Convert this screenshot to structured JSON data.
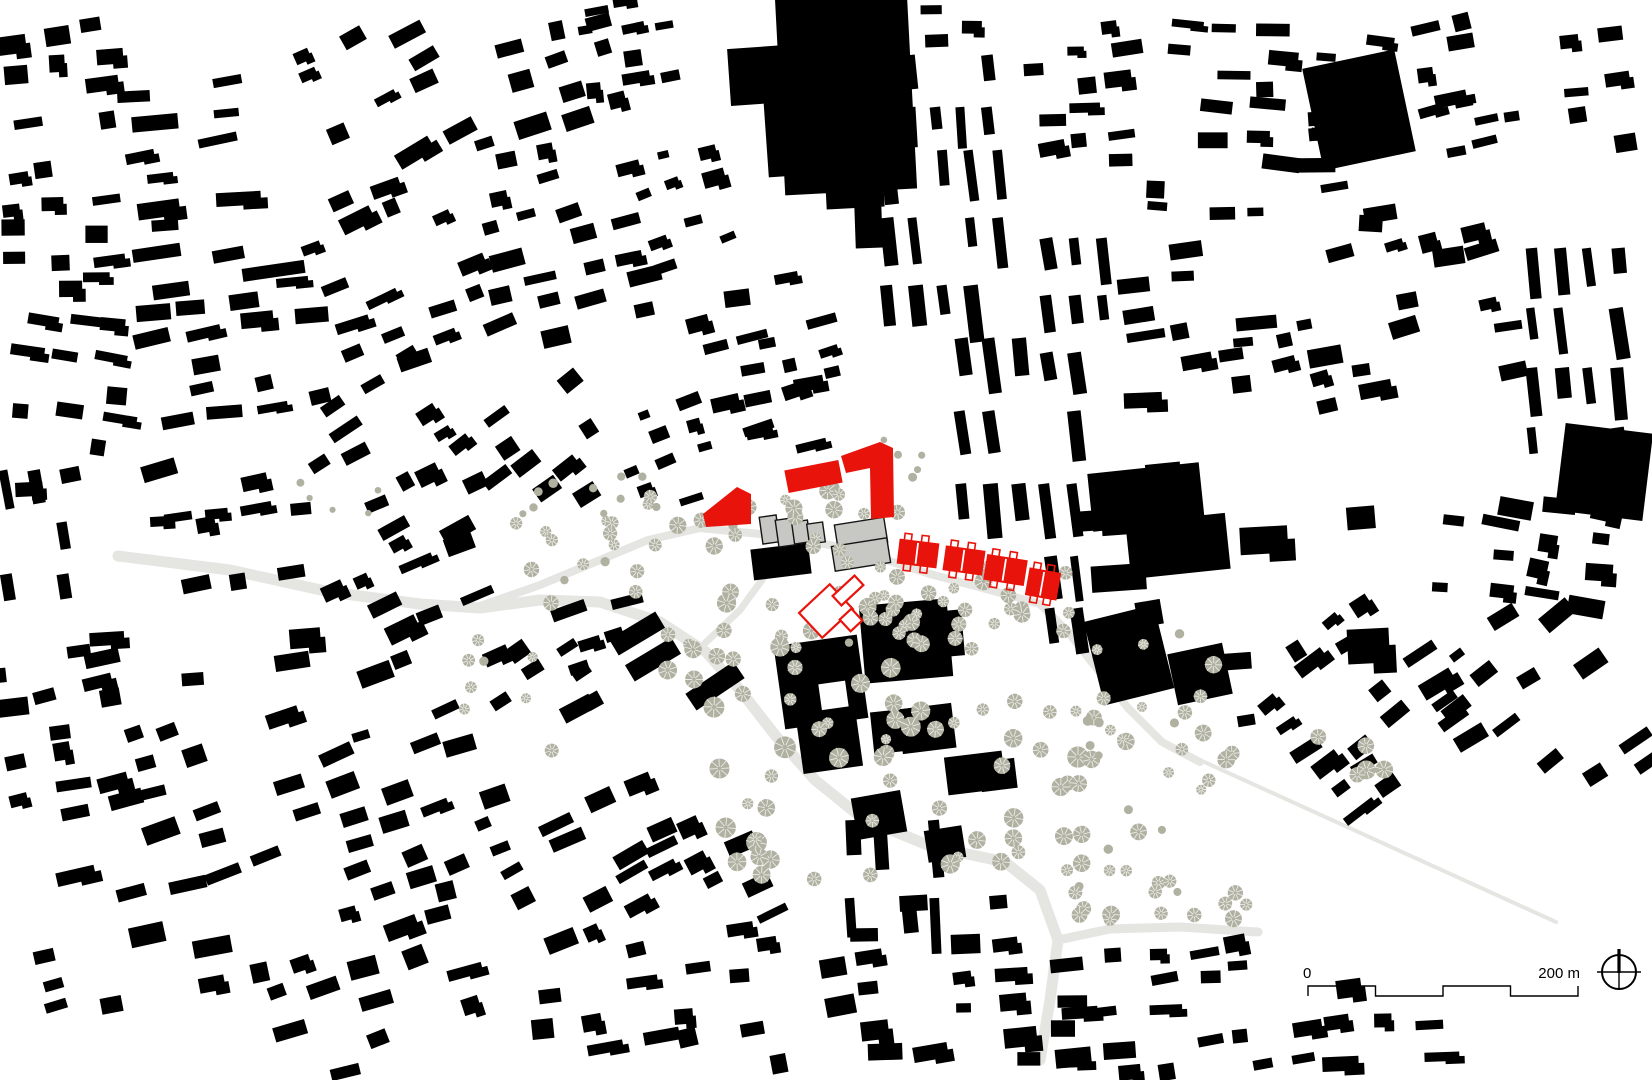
{
  "map": {
    "kind": "architectural figure-ground site plan",
    "canvas": {
      "w": 1652,
      "h": 1080
    }
  },
  "colors": {
    "background": "#ffffff",
    "building_black": "#000000",
    "accent_red": "#e8140b",
    "gray_building_fill": "#c7c7c3",
    "gray_building_stroke": "#141414",
    "tree": "#b1b1a2",
    "tree_spoke": "#ffffff",
    "road": "#e5e5e2",
    "ink": "#000000"
  },
  "scale_bar": {
    "label_start": "0",
    "label_end": "200 m",
    "x": 1308,
    "y": 986,
    "length": 270,
    "segments": 4,
    "drop": 10
  },
  "compass": {
    "cx": 1619,
    "cy": 972,
    "r": 17
  },
  "roads": [
    {
      "w": 11,
      "p": [
        [
          118,
          556
        ],
        [
          230,
          570
        ],
        [
          330,
          592
        ],
        [
          420,
          604
        ],
        [
          480,
          608
        ],
        [
          540,
          600
        ],
        [
          600,
          602
        ],
        [
          660,
          622
        ],
        [
          706,
          652
        ],
        [
          740,
          690
        ],
        [
          775,
          735
        ],
        [
          815,
          780
        ],
        [
          862,
          818
        ],
        [
          930,
          846
        ],
        [
          1005,
          862
        ],
        [
          1040,
          890
        ],
        [
          1058,
          940
        ],
        [
          1050,
          1000
        ],
        [
          1040,
          1060
        ]
      ]
    },
    {
      "w": 9,
      "p": [
        [
          1058,
          940
        ],
        [
          1110,
          929
        ],
        [
          1180,
          927
        ],
        [
          1258,
          932
        ]
      ]
    },
    {
      "w": 8,
      "p": [
        [
          480,
          606
        ],
        [
          540,
          585
        ],
        [
          600,
          560
        ],
        [
          648,
          540
        ],
        [
          700,
          528
        ],
        [
          770,
          535
        ],
        [
          830,
          545
        ],
        [
          880,
          558
        ],
        [
          930,
          574
        ],
        [
          990,
          590
        ],
        [
          1040,
          604
        ],
        [
          1068,
          632
        ],
        [
          1098,
          670
        ],
        [
          1128,
          708
        ],
        [
          1162,
          742
        ],
        [
          1200,
          762
        ]
      ]
    },
    {
      "w": 4,
      "p": [
        [
          1200,
          760
        ],
        [
          1556,
          922
        ]
      ]
    },
    {
      "w": 7,
      "p": [
        [
          700,
          648
        ],
        [
          740,
          610
        ],
        [
          762,
          580
        ],
        [
          775,
          552
        ]
      ]
    }
  ],
  "black_clusters": [
    [
      5,
      25,
      150,
      130,
      -8,
      26,
      15,
      0.7,
      11
    ],
    [
      138,
      85,
      158,
      200,
      -7,
      45,
      13,
      0.8,
      22
    ],
    [
      312,
      10,
      165,
      150,
      -27,
      28,
      13,
      0.65,
      33
    ],
    [
      478,
      25,
      175,
      170,
      -15,
      25,
      14,
      0.65,
      44
    ],
    [
      585,
      0,
      95,
      105,
      -8,
      20,
      12,
      0.55,
      55
    ],
    [
      640,
      150,
      90,
      120,
      -18,
      20,
      12,
      0.5,
      66
    ],
    [
      930,
      0,
      80,
      60,
      -4,
      22,
      13,
      0.5,
      77
    ],
    [
      1035,
      25,
      115,
      170,
      -6,
      22,
      13,
      0.6,
      88
    ],
    [
      1160,
      25,
      250,
      200,
      3,
      28,
      13,
      0.65,
      99
    ],
    [
      1420,
      10,
      110,
      160,
      -12,
      24,
      13,
      0.5,
      110
    ],
    [
      1558,
      25,
      90,
      130,
      -8,
      24,
      13,
      0.5,
      115
    ],
    [
      1310,
      95,
      180,
      125,
      -8,
      25,
      13,
      0.45,
      117
    ],
    [
      5,
      165,
      135,
      150,
      -4,
      24,
      14,
      0.6,
      121
    ],
    [
      145,
      290,
      175,
      135,
      -9,
      28,
      14,
      0.7,
      132
    ],
    [
      318,
      175,
      170,
      190,
      -22,
      25,
      14,
      0.6,
      143
    ],
    [
      495,
      205,
      165,
      180,
      -15,
      25,
      14,
      0.6,
      154
    ],
    [
      700,
      285,
      115,
      130,
      -10,
      23,
      13,
      0.55,
      165
    ],
    [
      735,
      330,
      110,
      118,
      -14,
      24,
      13,
      0.6,
      616
    ],
    [
      755,
      418,
      85,
      52,
      -12,
      22,
      12,
      0.55,
      627
    ],
    [
      1120,
      245,
      180,
      170,
      -7,
      30,
      13,
      0.7,
      187
    ],
    [
      1310,
      235,
      205,
      185,
      -13,
      25,
      14,
      0.6,
      198
    ],
    [
      1240,
      330,
      80,
      90,
      -10,
      24,
      13,
      0.5,
      594
    ],
    [
      10,
      320,
      130,
      145,
      7,
      25,
      14,
      0.55,
      220
    ],
    [
      300,
      372,
      180,
      130,
      -30,
      25,
      13,
      0.55,
      231
    ],
    [
      150,
      418,
      165,
      125,
      -12,
      25,
      14,
      0.55,
      242
    ],
    [
      470,
      390,
      160,
      125,
      -34,
      23,
      13,
      0.5,
      253
    ],
    [
      628,
      408,
      85,
      105,
      -20,
      19,
      11,
      0.6,
      264
    ],
    [
      60,
      425,
      80,
      70,
      -10,
      27,
      15,
      0.5,
      286
    ],
    [
      20,
      480,
      70,
      60,
      -6,
      24,
      14,
      0.5,
      660
    ],
    [
      155,
      480,
      170,
      70,
      -8,
      26,
      14,
      0.5,
      649
    ],
    [
      380,
      470,
      110,
      80,
      -25,
      24,
      13,
      0.5,
      638
    ],
    [
      90,
      580,
      235,
      130,
      -8,
      27,
      15,
      0.65,
      308
    ],
    [
      335,
      555,
      175,
      145,
      -24,
      25,
      14,
      0.55,
      319
    ],
    [
      1090,
      465,
      120,
      115,
      -6,
      40,
      22,
      0.6,
      341
    ],
    [
      1240,
      475,
      90,
      110,
      -4,
      36,
      24,
      0.55,
      352
    ],
    [
      1335,
      510,
      95,
      155,
      -2,
      38,
      26,
      0.5,
      363
    ],
    [
      1440,
      500,
      210,
      110,
      8,
      27,
      15,
      0.55,
      374
    ],
    [
      1130,
      555,
      105,
      95,
      -6,
      34,
      20,
      0.5,
      396
    ],
    [
      505,
      625,
      135,
      145,
      -31,
      24,
      13,
      0.55,
      407
    ],
    [
      570,
      600,
      70,
      90,
      -15,
      26,
      15,
      0.5,
      418
    ],
    [
      0,
      655,
      140,
      185,
      -11,
      27,
      15,
      0.7,
      429
    ],
    [
      140,
      700,
      195,
      175,
      -17,
      27,
      15,
      0.7,
      440
    ],
    [
      335,
      718,
      190,
      175,
      -21,
      26,
      14,
      0.65,
      451
    ],
    [
      30,
      855,
      225,
      175,
      -13,
      29,
      16,
      0.65,
      462
    ],
    [
      262,
      898,
      245,
      172,
      -17,
      27,
      15,
      0.65,
      473
    ],
    [
      520,
      795,
      185,
      155,
      -26,
      26,
      14,
      0.6,
      484
    ],
    [
      540,
      945,
      230,
      130,
      -9,
      27,
      15,
      0.65,
      495
    ],
    [
      655,
      820,
      110,
      120,
      -24,
      24,
      13,
      0.55,
      506
    ],
    [
      770,
      895,
      200,
      180,
      -6,
      26,
      15,
      0.6,
      517
    ],
    [
      960,
      900,
      130,
      175,
      -4,
      26,
      15,
      0.55,
      539
    ],
    [
      1060,
      1000,
      300,
      78,
      -6,
      26,
      14,
      0.6,
      553
    ],
    [
      1115,
      945,
      140,
      58,
      -6,
      22,
      13,
      0.45,
      557
    ],
    [
      1280,
      600,
      200,
      200,
      -35,
      26,
      14,
      0.5,
      550
    ],
    [
      1460,
      600,
      190,
      230,
      -35,
      25,
      14,
      0.42,
      561
    ],
    [
      1330,
      1020,
      120,
      60,
      -4,
      26,
      14,
      0.45,
      572
    ],
    [
      1150,
      660,
      120,
      110,
      -8,
      24,
      13,
      0.3,
      605
    ]
  ],
  "strip_clusters": [
    [
      882,
      150,
      125,
      185,
      -6,
      12,
      52,
      701
    ],
    [
      905,
      55,
      100,
      92,
      -5,
      11,
      40,
      702
    ],
    [
      1528,
      248,
      118,
      245,
      -7,
      12,
      46,
      703
    ],
    [
      1042,
      238,
      85,
      175,
      -8,
      12,
      44,
      704
    ],
    [
      957,
      338,
      140,
      200,
      -7,
      12,
      56,
      705
    ],
    [
      2,
      470,
      70,
      172,
      -10,
      12,
      40,
      706
    ],
    [
      1047,
      556,
      56,
      102,
      -7,
      11,
      40,
      707
    ],
    [
      846,
      820,
      100,
      150,
      -4,
      12,
      60,
      708
    ]
  ],
  "landmarks": [
    {
      "r": [
        780,
        -6,
        132,
        198
      ],
      "a": -3
    },
    {
      "r": [
        729,
        47,
        58,
        57
      ],
      "a": -4
    },
    {
      "r": [
        766,
        96,
        42,
        80
      ],
      "a": -4
    },
    {
      "r": [
        826,
        182,
        58,
        26
      ],
      "a": -3
    },
    {
      "r": [
        855,
        203,
        27,
        45
      ],
      "a": -2
    },
    {
      "r": [
        752,
        546,
        58,
        31
      ],
      "a": -7
    },
    {
      "r": [
        779,
        640,
        84,
        84
      ],
      "a": -8,
      "hole": [
        818,
        684,
        27,
        26
      ]
    },
    {
      "r": [
        800,
        722,
        60,
        48
      ],
      "a": -8
    },
    {
      "r": [
        862,
        602,
        88,
        78
      ],
      "a": -5
    },
    {
      "r": [
        946,
        610,
        17,
        46
      ],
      "a": -5
    },
    {
      "r": [
        872,
        710,
        45,
        42
      ],
      "a": -6
    },
    {
      "r": [
        686,
        676,
        58,
        20
      ],
      "a": -34
    },
    {
      "r": [
        610,
        624,
        54,
        19
      ],
      "a": -31
    },
    {
      "r": [
        626,
        650,
        54,
        19
      ],
      "a": -31
    },
    {
      "r": [
        900,
        706,
        54,
        45
      ],
      "a": -7
    },
    {
      "r": [
        946,
        754,
        58,
        38
      ],
      "a": -7
    },
    {
      "r": [
        854,
        794,
        50,
        42
      ],
      "a": -10
    },
    {
      "r": [
        926,
        828,
        38,
        32
      ],
      "a": -9
    },
    {
      "r": [
        980,
        760,
        36,
        30
      ],
      "a": -7
    },
    {
      "r": [
        1090,
        468,
        112,
        58
      ],
      "a": -6
    },
    {
      "r": [
        1128,
        518,
        100,
        56
      ],
      "a": -6
    },
    {
      "r": [
        1093,
        612,
        72,
        86
      ],
      "a": -14
    },
    {
      "r": [
        1172,
        648,
        56,
        52
      ],
      "a": -12
    },
    {
      "r": [
        1312,
        58,
        94,
        104
      ],
      "a": -12
    },
    {
      "r": [
        1560,
        428,
        88,
        88
      ],
      "a": 7
    }
  ],
  "gray_buildings": [
    [
      761,
      516,
      17,
      27,
      -8
    ],
    [
      777,
      519,
      17,
      27,
      -8
    ],
    [
      793,
      521,
      16,
      22,
      -8
    ],
    [
      808,
      523,
      16,
      20,
      -8
    ],
    [
      836,
      521,
      50,
      25,
      -9
    ],
    [
      833,
      542,
      56,
      25,
      -9
    ]
  ],
  "red_buildings": {
    "polygons": [
      [
        [
          703,
          514
        ],
        [
          737,
          487
        ],
        [
          751,
          494
        ],
        [
          751,
          524
        ],
        [
          706,
          527
        ]
      ],
      [
        [
          841,
          456
        ],
        [
          880,
          442
        ],
        [
          893,
          448
        ],
        [
          894,
          517
        ],
        [
          871,
          519
        ],
        [
          870,
          468
        ],
        [
          846,
          473
        ]
      ]
    ],
    "bars": [
      [
        786,
        465,
        55,
        23,
        -11
      ]
    ],
    "row_blocks": [
      [
        898,
        541,
        40,
        25,
        7
      ],
      [
        944,
        548,
        40,
        25,
        8
      ],
      [
        985,
        557,
        41,
        26,
        9
      ],
      [
        1027,
        570,
        32,
        28,
        10
      ]
    ]
  },
  "red_outline_buildings": [
    [
      805,
      594,
      42,
      34,
      -43
    ],
    [
      833,
      584,
      30,
      13,
      -43
    ],
    [
      843,
      612,
      16,
      16,
      -43
    ]
  ],
  "tree_clusters": [
    [
      640,
      478,
      260,
      72,
      24,
      4,
      9,
      801
    ],
    [
      880,
      558,
      200,
      92,
      24,
      5,
      9,
      802
    ],
    [
      620,
      560,
      290,
      150,
      24,
      4,
      10,
      803
    ],
    [
      700,
      588,
      200,
      62,
      14,
      6,
      10,
      804
    ],
    [
      700,
      700,
      380,
      180,
      46,
      5,
      11,
      805
    ],
    [
      1060,
      620,
      200,
      170,
      16,
      4,
      9,
      806
    ],
    [
      1300,
      735,
      90,
      55,
      5,
      7,
      10,
      807
    ],
    [
      1150,
      865,
      115,
      60,
      8,
      6,
      9,
      808
    ],
    [
      500,
      518,
      130,
      92,
      12,
      4,
      8,
      809
    ],
    [
      460,
      640,
      120,
      120,
      8,
      4,
      7,
      810
    ],
    [
      878,
      438,
      45,
      45,
      6,
      3,
      5,
      811
    ],
    [
      1060,
      800,
      120,
      130,
      18,
      4,
      9,
      812
    ],
    [
      500,
      476,
      150,
      42,
      9,
      3,
      5,
      813
    ],
    [
      295,
      482,
      90,
      35,
      5,
      3,
      4,
      814
    ],
    [
      1080,
      700,
      140,
      90,
      10,
      4,
      7,
      815
    ]
  ]
}
